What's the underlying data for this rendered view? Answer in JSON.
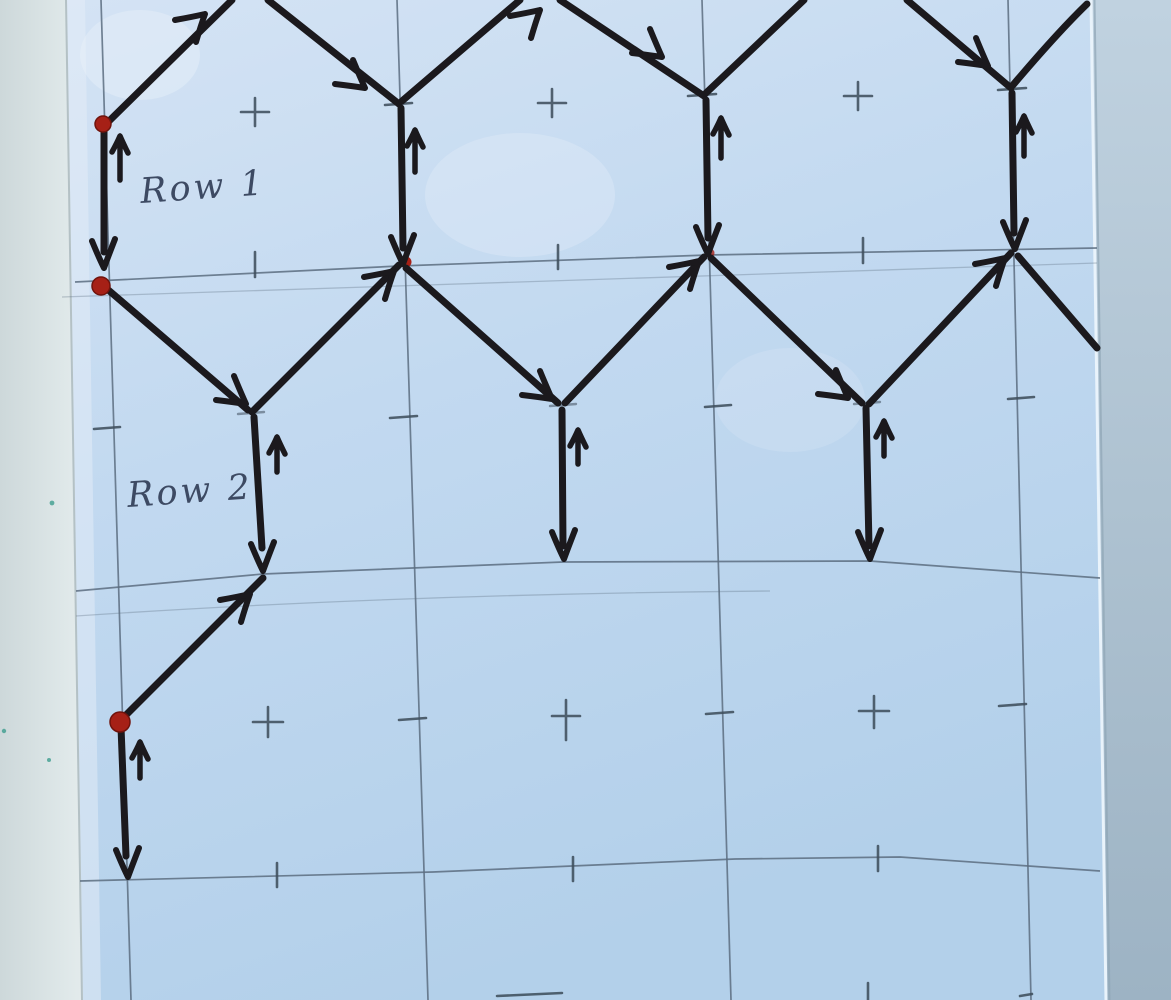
{
  "scene": {
    "kind": "photograph of a hand-drawn stitch/wire pattern diagram",
    "medium": "black marker and pencil on light blue paper"
  },
  "labels": {
    "row1": "Row 1",
    "row2": "Row 2"
  },
  "diagram": {
    "rows": [
      {
        "label": "Row 1",
        "description": "zigzag of peaks joined by vertical drops with down arrows and small up arrows"
      },
      {
        "label": "Row 2",
        "description": "V-shaped zigzag hanging from row 1 with vertical drops to second guideline"
      }
    ],
    "red_dot_count": 3,
    "pencil_grid": {
      "vertical_lines": 4,
      "horizontal_guidelines": 3
    },
    "plus_marks_top_row": 3,
    "plus_marks_lower_row": 3
  },
  "colors": {
    "ink": "#1b191d",
    "pencil": "#5c6d80",
    "tick": "#3f4e5c",
    "handwriting": "#3d4a63",
    "dot-red": "#a62016",
    "dot-red-dark": "#70130c",
    "paper": "#bdd7ef",
    "paper-light": "#d4e3f4",
    "bg-left": "#e9efef",
    "bg-left-dark": "#cdd8da",
    "bg-right-top": "#c0d2e0",
    "bg-right-bottom": "#9db3c4",
    "speck-teal": "#3f9e8f"
  }
}
